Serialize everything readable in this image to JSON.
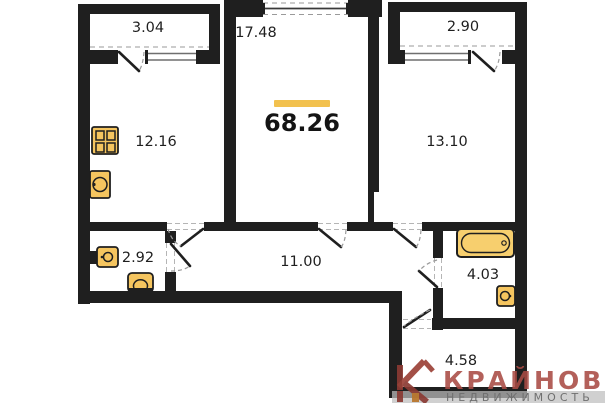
{
  "plan": {
    "total_area": "68.26",
    "rooms": [
      {
        "name": "balcony-left",
        "area": "3.04"
      },
      {
        "name": "living-room",
        "area": "17.48"
      },
      {
        "name": "balcony-right",
        "area": "2.90"
      },
      {
        "name": "kitchen",
        "area": "12.16"
      },
      {
        "name": "bedroom",
        "area": "13.10"
      },
      {
        "name": "wc",
        "area": "2.92"
      },
      {
        "name": "hallway",
        "area": "11.00"
      },
      {
        "name": "bathroom",
        "area": "4.03"
      },
      {
        "name": "entry-hall",
        "area": "4.58"
      }
    ],
    "fixtures": [
      "stove-icon",
      "kitchen-sink-icon",
      "wc-sink-icon",
      "toilet-icon",
      "bathtub-icon",
      "bath-sink-icon"
    ],
    "colors": {
      "wall": "#1f1f1f",
      "fixture_fill": "#f5c55f",
      "accent_bar": "#f2c14e"
    }
  },
  "logo": {
    "brand": "КРАЙНОВ",
    "subtitle": "НЕДВИЖИМОСТЬ",
    "colors": {
      "brand": "#a94b44",
      "subtitle": "#6f6f6f",
      "icon_primary": "#8a3a33",
      "icon_secondary": "#b9742a"
    }
  }
}
